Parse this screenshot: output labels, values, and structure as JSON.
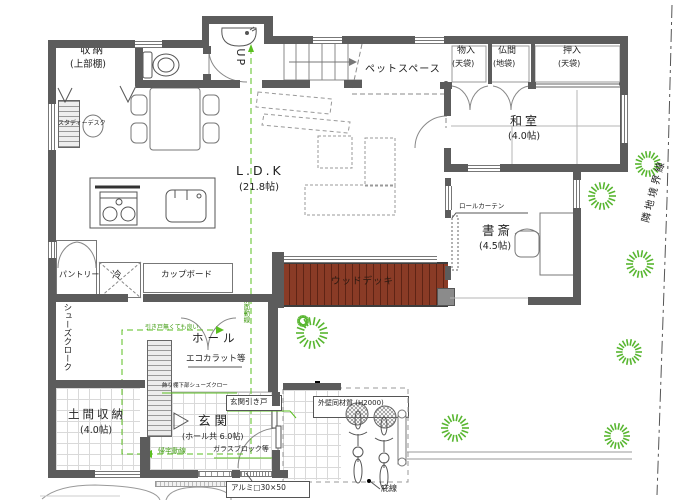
{
  "rooms": {
    "shuno": {
      "name": "収納",
      "note": "(上部棚)"
    },
    "ldk": {
      "name": "L.D.K",
      "size": "(21.8帖)"
    },
    "pet": {
      "name": "ペットスペース"
    },
    "washitsu": {
      "name": "和室",
      "size": "(4.0帖)"
    },
    "monoire": {
      "name": "物入",
      "note": "(天袋)"
    },
    "butsuma": {
      "name": "仏間",
      "note": "(地袋)"
    },
    "oshiire": {
      "name": "押入",
      "note": "(天袋)"
    },
    "shosai": {
      "name": "書斎",
      "size": "(4.5帖)"
    },
    "wooddeck": {
      "name": "ウッドデッキ"
    },
    "pantry": {
      "name": "パントリー"
    },
    "fridge": {
      "name": "冷"
    },
    "cupboard": {
      "name": "カップボード"
    },
    "shoescloak": {
      "name": "シューズクローク"
    },
    "hall": {
      "name": "ホール"
    },
    "doma": {
      "name": "土間収納",
      "size": "(4.0帖)"
    },
    "genkan": {
      "name": "玄関",
      "size": "(ホール共 6.0帖)"
    }
  },
  "annotations": {
    "up": "UP",
    "study_desk": "スタディーデスク",
    "roll_curtain": "ロールカーテン",
    "ecocarat": "エコカラット等",
    "no_sliding_door": "引き戸無くても良い",
    "washroom_line": "洗面動線",
    "return_line": "帰宅動線",
    "shoe_shelf": "飾り棚下部シューズクロー",
    "entrance_sliding": "玄関引き戸",
    "glass_block": "ガラスブロック等",
    "outer_wall": "外壁同材質 (H2000)",
    "alumi": "アルミ□30×50",
    "eaves": "庇線",
    "boundary": "隣地境界線"
  },
  "colors": {
    "wall": "#5c5c5c",
    "deck": "#8a3b26",
    "deckline": "#5f2415",
    "green": "#5abf1f",
    "greentext": "#3f9a10",
    "dash": "#8a8a8a"
  }
}
